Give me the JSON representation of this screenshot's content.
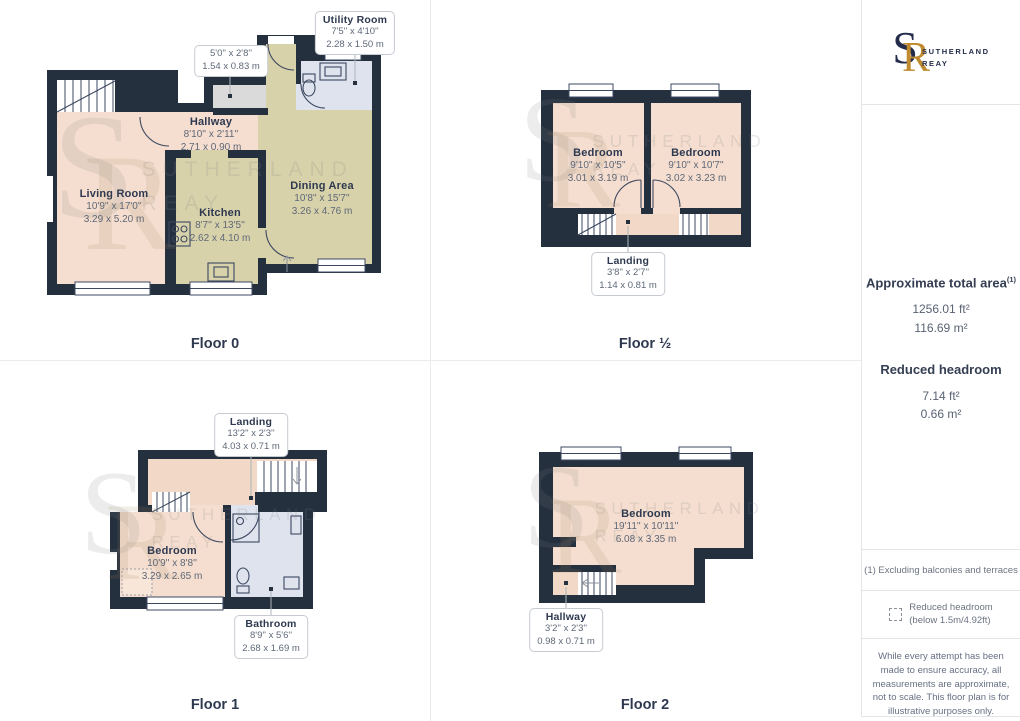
{
  "brand": {
    "monogram_s": "S",
    "monogram_r": "R",
    "line1": "SUTHERLAND",
    "line2": "REAY"
  },
  "colors": {
    "wall": "#25303f",
    "room_pink": "#f5decf",
    "room_pale": "#f2d8c6",
    "room_tan": "#d8d2ab",
    "room_blue": "#dee3ee",
    "closet_gray": "#dadada",
    "brand_navy": "#232c4a",
    "brand_gold": "#bf8b2e"
  },
  "floors": [
    {
      "label": "Floor 0",
      "rooms": [
        {
          "name": "Utility Room",
          "ft": "7'5'' x 4'10''",
          "m": "2.28 x 1.50 m"
        },
        {
          "ft": "5'0'' x 2'8''",
          "m": "1.54 x 0.83 m"
        },
        {
          "name": "Hallway",
          "ft": "8'10'' x 2'11''",
          "m": "2.71 x 0.90 m"
        },
        {
          "name": "Living Room",
          "ft": "10'9'' x 17'0''",
          "m": "3.29 x 5.20 m"
        },
        {
          "name": "Kitchen",
          "ft": "8'7'' x 13'5''",
          "m": "2.62 x 4.10 m"
        },
        {
          "name": "Dining Area",
          "ft": "10'8'' x 15'7''",
          "m": "3.26 x 4.76 m"
        }
      ]
    },
    {
      "label": "Floor ½",
      "rooms": [
        {
          "name": "Bedroom",
          "ft": "9'10'' x 10'5''",
          "m": "3.01 x 3.19 m"
        },
        {
          "name": "Bedroom",
          "ft": "9'10'' x 10'7''",
          "m": "3.02 x 3.23 m"
        },
        {
          "name": "Landing",
          "ft": "3'8'' x 2'7''",
          "m": "1.14 x 0.81 m"
        }
      ]
    },
    {
      "label": "Floor 1",
      "rooms": [
        {
          "name": "Landing",
          "ft": "13'2'' x 2'3''",
          "m": "4.03 x 0.71 m"
        },
        {
          "name": "Bedroom",
          "ft": "10'9'' x 8'8''",
          "m": "3.29 x 2.65 m"
        },
        {
          "name": "Bathroom",
          "ft": "8'9'' x 5'6''",
          "m": "2.68 x 1.69 m"
        }
      ]
    },
    {
      "label": "Floor 2",
      "rooms": [
        {
          "name": "Bedroom",
          "ft": "19'11'' x 10'11''",
          "m": "6.08 x 3.35 m"
        },
        {
          "name": "Hallway",
          "ft": "3'2'' x 2'3''",
          "m": "0.98 x 0.71 m"
        }
      ]
    }
  ],
  "sidebar": {
    "area_title": "Approximate total area",
    "area_superscript": "(1)",
    "area_ft": "1256.01 ft²",
    "area_m": "116.69 m²",
    "headroom_title": "Reduced headroom",
    "headroom_ft": "7.14 ft²",
    "headroom_m": "0.66 m²",
    "footnote": "(1) Excluding balconies and terraces",
    "legend_line1": "Reduced headroom",
    "legend_line2": "(below 1.5m/4.92ft)",
    "disclaimer": "While every attempt has been made to ensure accuracy, all measurements are approximate, not to scale. This floor plan is for illustrative purposes only.",
    "brand_footer_regular": "GIRAFFE",
    "brand_footer_bold": "360"
  }
}
